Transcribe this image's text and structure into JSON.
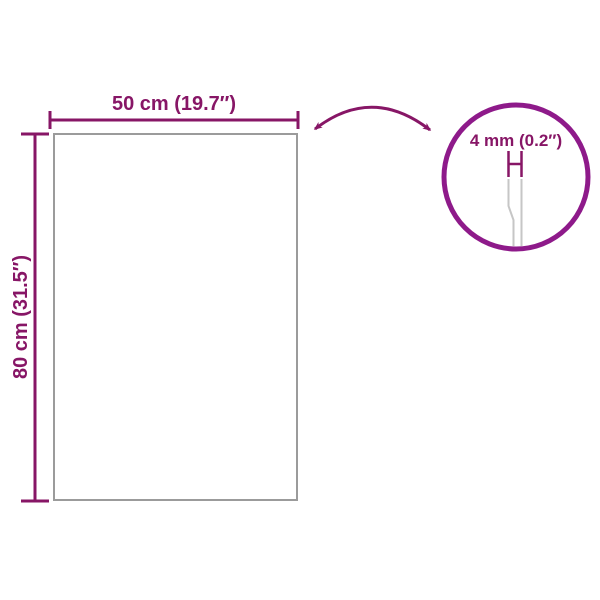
{
  "diagram": {
    "type": "product-dimension-diagram",
    "width_label": "50 cm (19.7″)",
    "height_label": "80 cm (31.5″)",
    "thickness_label": "4 mm (0.2″)"
  },
  "colors": {
    "accent": "#871666",
    "circle_stroke": "#8E1A8A",
    "panel_stroke": "#9B9B9B",
    "glass_edge": "#C6C6C6",
    "background": "#FFFFFF"
  }
}
